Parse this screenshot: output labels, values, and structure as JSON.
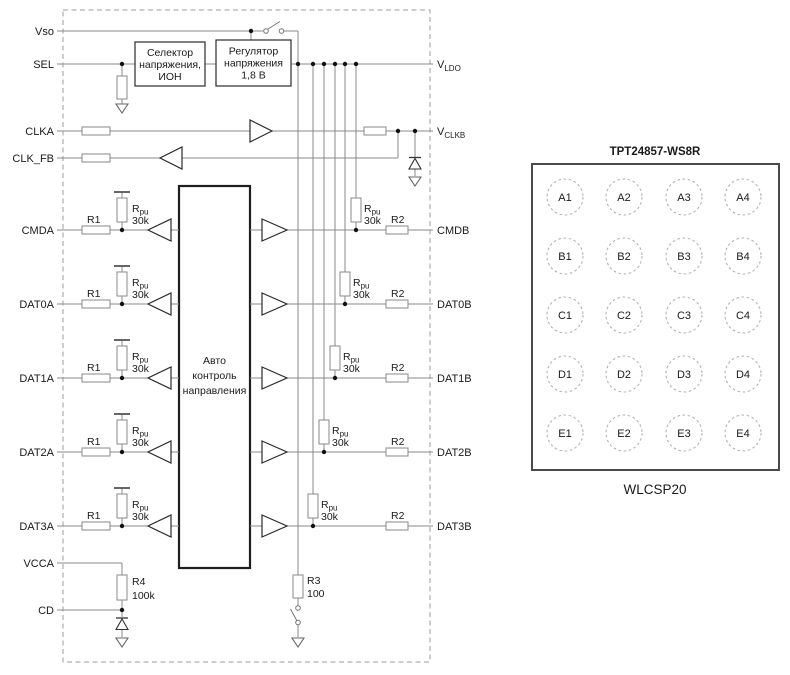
{
  "diagram": {
    "pins_left": {
      "vso": "Vso",
      "sel": "SEL",
      "clka": "CLKA",
      "clk_fb": "CLK_FB",
      "vcca": "VCCA",
      "cd": "CD"
    },
    "pin_vldo": {
      "base": "V",
      "sub": "LDO"
    },
    "pin_vclkb": {
      "base": "V",
      "sub": "CLKB"
    },
    "channels": [
      {
        "a": "CMDA",
        "b": "CMDB"
      },
      {
        "a": "DAT0A",
        "b": "DAT0B"
      },
      {
        "a": "DAT1A",
        "b": "DAT1B"
      },
      {
        "a": "DAT2A",
        "b": "DAT2B"
      },
      {
        "a": "DAT3A",
        "b": "DAT3B"
      }
    ],
    "resistors": {
      "r1": "R1",
      "r2": "R2",
      "rpu_base": "R",
      "rpu_sub": "pu",
      "rpu_value": "30k",
      "r3": {
        "name": "R3",
        "value": "100"
      },
      "r4": {
        "name": "R4",
        "value": "100k"
      }
    },
    "blocks": {
      "selector": [
        "Селектор",
        "напряжения,",
        "ИОН"
      ],
      "regulator": [
        "Регулятор",
        "напряжения",
        "1,8 В"
      ],
      "auto": [
        "Авто",
        "контроль",
        "направления"
      ]
    }
  },
  "package": {
    "title": "TPT24857-WS8R",
    "caption": "WLCSP20",
    "balls": [
      "A1",
      "A2",
      "A3",
      "A4",
      "B1",
      "B2",
      "B3",
      "B4",
      "C1",
      "C2",
      "C3",
      "C4",
      "D1",
      "D2",
      "D3",
      "D4",
      "E1",
      "E2",
      "E3",
      "E4"
    ]
  },
  "colors": {
    "wire": "#8a8a8a",
    "text": "#1a1a1a",
    "block_border": "#2b2b2b",
    "dashed_border": "#9c9c9c",
    "background": "#ffffff"
  }
}
